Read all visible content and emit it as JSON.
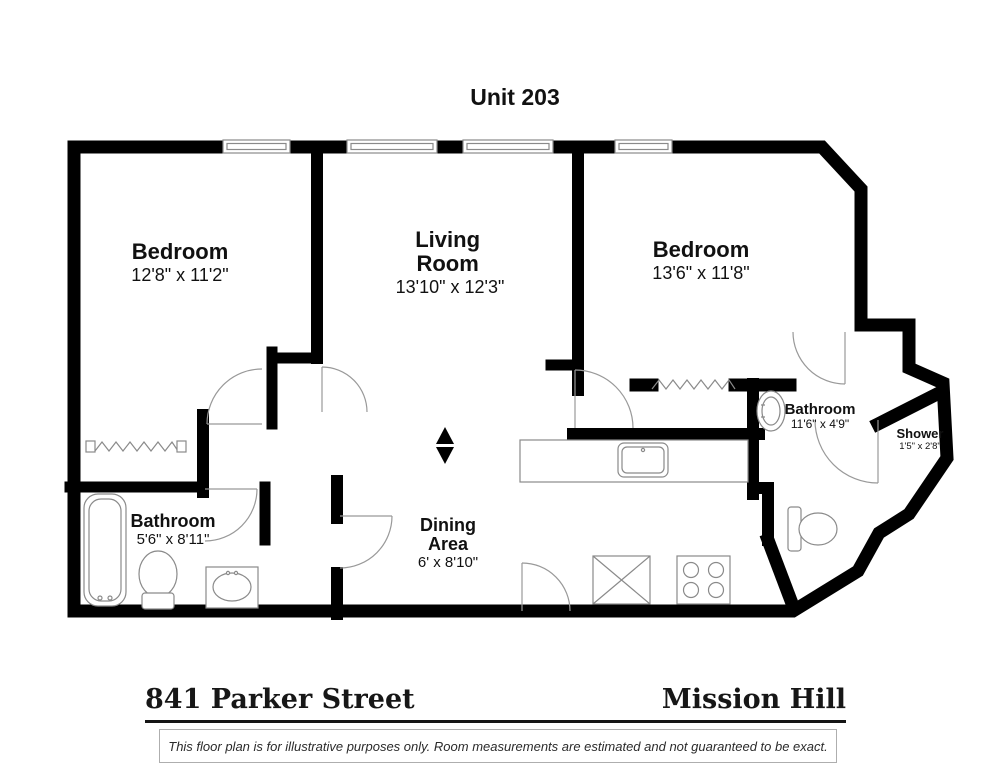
{
  "title": "Unit 203",
  "rooms": [
    {
      "name": "Bedroom",
      "dims": "12'8\" x 11'2\""
    },
    {
      "name": "Living Room",
      "dims": "13'10\" x 12'3\""
    },
    {
      "name": "Bedroom",
      "dims": "13'6\" x 11'8\""
    },
    {
      "name": "Bathroom",
      "dims": "11'6\" x 4'9\""
    },
    {
      "name": "Shower",
      "dims": "1'5\" x 2'8\""
    },
    {
      "name": "Bathroom",
      "dims": "5'6\" x 8'11\""
    },
    {
      "name": "Dining Area",
      "dims": "6' x 8'10\""
    }
  ],
  "footer": {
    "address": "841 Parker Street",
    "neighborhood": "Mission Hill"
  },
  "disclaimer": "This floor plan is for illustrative purposes only. Room measurements are estimated and not guaranteed to be exact.",
  "icons": {
    "north_arrow": "north-arrow"
  },
  "colors": {
    "wall": "#000000",
    "fixture_outline": "#8a8a8a",
    "door_arc": "#999999",
    "text": "#111111",
    "background": "#ffffff"
  }
}
